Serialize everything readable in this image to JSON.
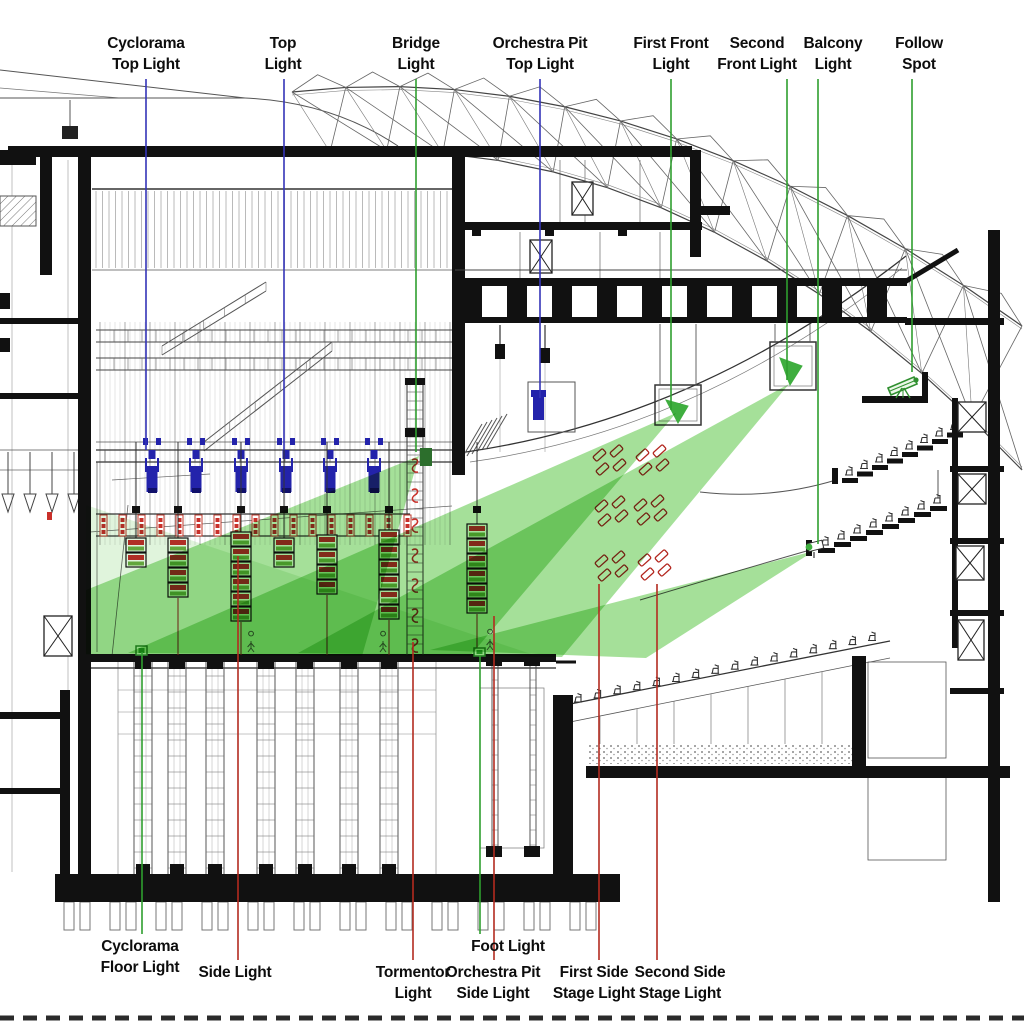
{
  "diagram": {
    "title": "Theater section — stage lighting positions",
    "type": "architectural-section-lighting-diagram"
  },
  "colors": {
    "background": "#ffffff",
    "ink": "#1a1a1a",
    "line": "#555555",
    "beam_green": "#52c33c",
    "leader_green": "#2f9e2f",
    "leader_blue": "#3434b8",
    "leader_red": "#b32b20",
    "fixture_blue": "#2323ab",
    "fixture_red": "#c9302a",
    "fixture_green": "#3fae3f"
  },
  "labels": {
    "top": [
      {
        "id": "cyclorama-top-light",
        "lines": [
          "Cyclorama",
          "Top Light"
        ],
        "x": 146,
        "y": 33,
        "leader": {
          "x": 146,
          "color": "blue",
          "from": 79,
          "to": 450
        }
      },
      {
        "id": "top-light",
        "lines": [
          "Top",
          "Light"
        ],
        "x": 283,
        "y": 33,
        "leader": {
          "x": 284,
          "color": "blue",
          "from": 79,
          "to": 450
        }
      },
      {
        "id": "bridge-light",
        "lines": [
          "Bridge",
          "Light"
        ],
        "x": 416,
        "y": 33,
        "leader": {
          "x": 416,
          "color": "green",
          "from": 79,
          "to": 452
        }
      },
      {
        "id": "orchestra-pit-top-light",
        "lines": [
          "Orchestra Pit",
          "Top Light"
        ],
        "x": 540,
        "y": 33,
        "leader": {
          "x": 540,
          "color": "blue",
          "from": 79,
          "to": 398
        }
      },
      {
        "id": "first-front-light",
        "lines": [
          "First Front",
          "Light"
        ],
        "x": 671,
        "y": 33,
        "leader": {
          "x": 671,
          "color": "green",
          "from": 79,
          "to": 410
        }
      },
      {
        "id": "second-front-light",
        "lines": [
          "Second",
          "Front Light"
        ],
        "x": 757,
        "y": 33,
        "leader": {
          "x": 787,
          "color": "green",
          "from": 79,
          "to": 380
        }
      },
      {
        "id": "balcony-light",
        "lines": [
          "Balcony",
          "Light"
        ],
        "x": 833,
        "y": 33,
        "leader": {
          "x": 818,
          "color": "green",
          "from": 79,
          "to": 544
        }
      },
      {
        "id": "follow-spot",
        "lines": [
          "Follow",
          "Spot"
        ],
        "x": 919,
        "y": 33,
        "leader": {
          "x": 912,
          "color": "green",
          "from": 79,
          "to": 372
        }
      }
    ],
    "bottom": [
      {
        "id": "cyclorama-floor-light",
        "lines": [
          "Cyclorama",
          "Floor Light"
        ],
        "x": 140,
        "y": 936,
        "leader": {
          "x": 142,
          "color": "green",
          "from": 934,
          "to": 652
        }
      },
      {
        "id": "side-light",
        "lines": [
          "Side Light"
        ],
        "x": 235,
        "y": 962,
        "leader": {
          "x": 238,
          "color": "red",
          "from": 960,
          "to": 556
        }
      },
      {
        "id": "tormentor-light",
        "lines": [
          "Tormentor",
          "Light"
        ],
        "x": 413,
        "y": 962,
        "leader": {
          "x": 413,
          "color": "red",
          "from": 960,
          "to": 642
        }
      },
      {
        "id": "orchestra-pit-side-light",
        "lines": [
          "Orchestra Pit",
          "Side Light"
        ],
        "x": 493,
        "y": 962,
        "leader": {
          "x": 494,
          "color": "red",
          "from": 960,
          "to": 616
        }
      },
      {
        "id": "foot-light",
        "lines": [
          "Foot Light"
        ],
        "x": 508,
        "y": 936,
        "leader": {
          "x": 480,
          "color": "green",
          "from": 934,
          "to": 656
        }
      },
      {
        "id": "first-side-stage-light",
        "lines": [
          "First Side",
          "Stage Light"
        ],
        "x": 594,
        "y": 962,
        "leader": {
          "x": 599,
          "color": "red",
          "from": 960,
          "to": 584
        }
      },
      {
        "id": "second-side-stage-light",
        "lines": [
          "Second Side",
          "Stage Light"
        ],
        "x": 680,
        "y": 962,
        "leader": {
          "x": 657,
          "color": "red",
          "from": 960,
          "to": 584
        }
      }
    ]
  }
}
